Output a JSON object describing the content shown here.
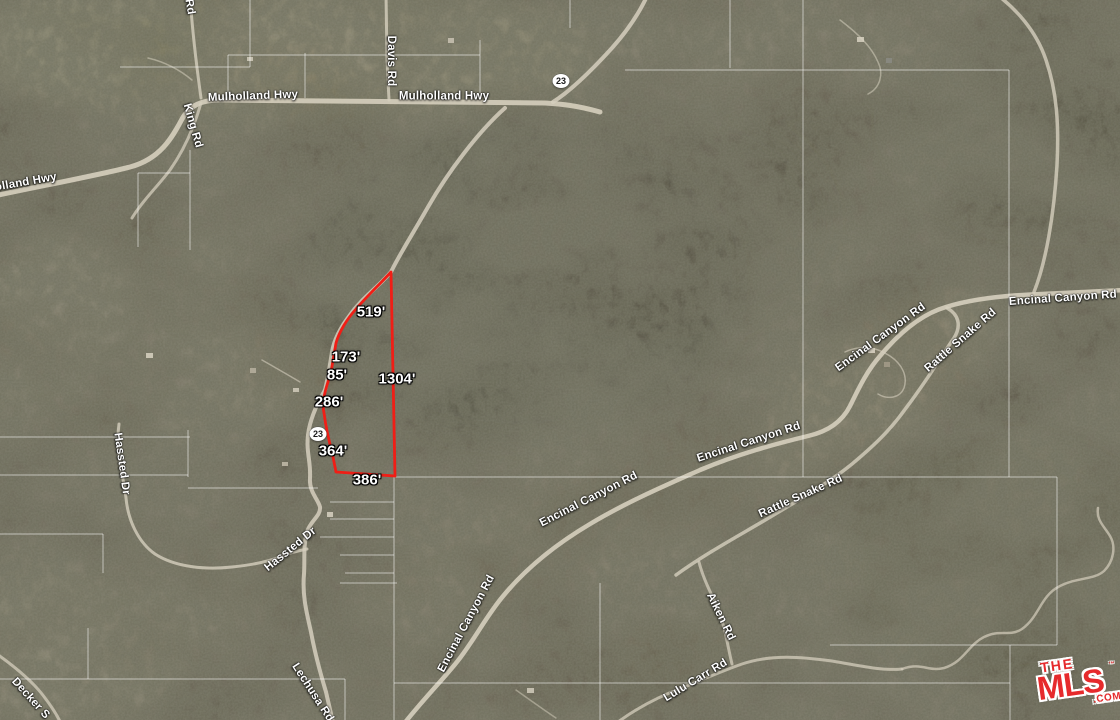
{
  "map": {
    "colors": {
      "parcel_red": "#f01e16",
      "label_white": "#ffffff",
      "logo_red": "#e62a2c",
      "road_light": "#d6cfbe"
    },
    "road_labels": [
      {
        "text": "Mulholland Hwy"
      },
      {
        "text": "Mulholland Hwy"
      },
      {
        "text": "olland Hwy"
      },
      {
        "text": "King Rd"
      },
      {
        "text": "Rd"
      },
      {
        "text": "Davis Rd"
      },
      {
        "text": "Encinal Canyon Rd"
      },
      {
        "text": "Encinal Canyon Rd"
      },
      {
        "text": "Rattle Snake Rd"
      },
      {
        "text": "Encinal Canyon Rd"
      },
      {
        "text": "Encinal Canyon Rd"
      },
      {
        "text": "Encinal Canyon Rd"
      },
      {
        "text": "Rattle Snake Rd"
      },
      {
        "text": "Hassted Dr"
      },
      {
        "text": "Hassted Dr"
      },
      {
        "text": "Lechusa Rd"
      },
      {
        "text": "Aiken Rd"
      },
      {
        "text": "Lulu Carr Rd"
      },
      {
        "text": "Decker S"
      }
    ],
    "route_shields": [
      {
        "number": "23"
      },
      {
        "number": "23"
      }
    ],
    "parcel": {
      "measurements": [
        {
          "value": "519'"
        },
        {
          "value": "173'"
        },
        {
          "value": "85'"
        },
        {
          "value": "1304'"
        },
        {
          "value": "286'"
        },
        {
          "value": "364'"
        },
        {
          "value": "386'"
        }
      ]
    },
    "logo": {
      "line1": "THE",
      "line2": "MLS",
      "tm": "™",
      "suffix": ".COM"
    }
  }
}
